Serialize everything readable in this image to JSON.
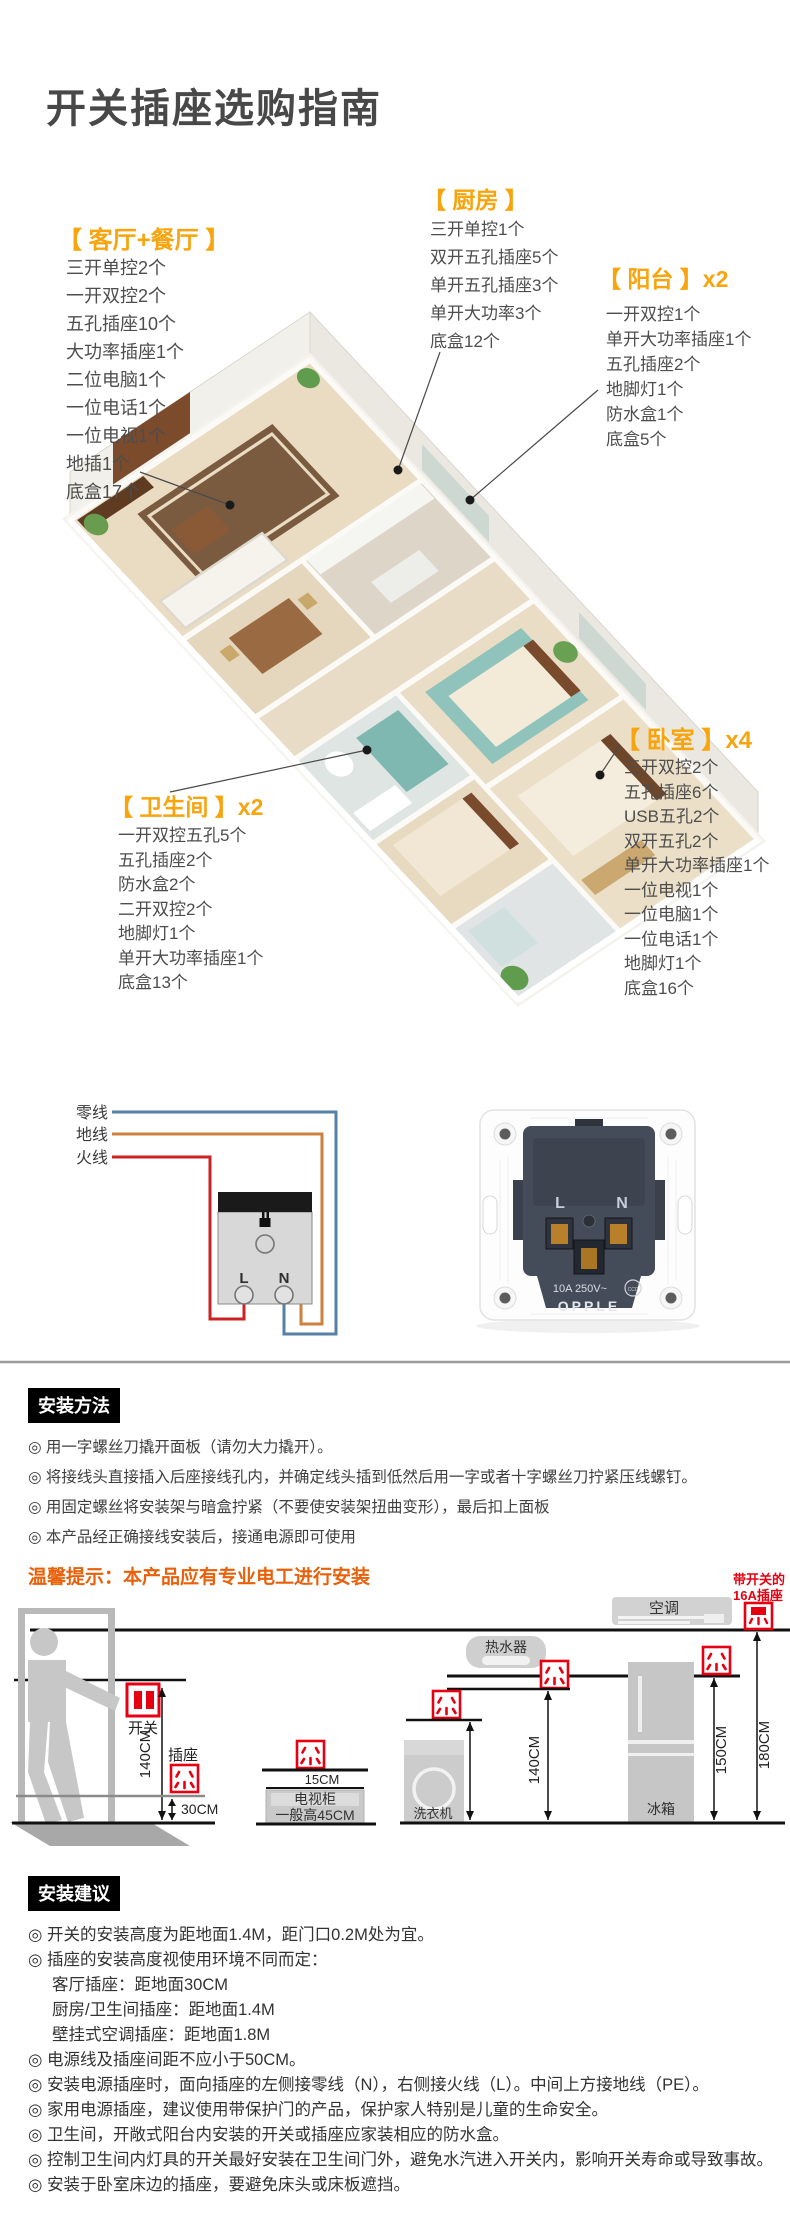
{
  "page": {
    "title": "开关插座选购指南"
  },
  "rooms": {
    "living": {
      "label": "【 客厅+餐厅 】",
      "items": [
        "三开单控2个",
        "一开双控2个",
        "五孔插座10个",
        "大功率插座1个",
        "二位电脑1个",
        "一位电话1个",
        "一位电视1个",
        "地插1个",
        "底盒17个"
      ]
    },
    "kitchen": {
      "label": "【 厨房 】",
      "items": [
        "三开单控1个",
        "双开五孔插座5个",
        "单开五孔插座3个",
        "单开大功率3个",
        "底盒12个"
      ]
    },
    "balcony": {
      "label": "【 阳台 】x2",
      "items": [
        "一开双控1个",
        "单开大功率插座1个",
        "五孔插座2个",
        "地脚灯1个",
        "防水盒1个",
        "底盒5个"
      ]
    },
    "bedroom": {
      "label": "【 卧室 】x4",
      "items": [
        "三开双控2个",
        "五孔插座6个",
        "USB五孔2个",
        "双开五孔2个",
        "单开大功率插座1个",
        "一位电视1个",
        "一位电脑1个",
        "一位电话1个",
        "地脚灯1个",
        "底盒16个"
      ]
    },
    "bathroom": {
      "label": "【 卫生间 】x2",
      "items": [
        "一开双控五孔5个",
        "五孔插座2个",
        "防水盒2个",
        "二开双控2个",
        "地脚灯1个",
        "单开大功率插座1个",
        "底盒13个"
      ]
    }
  },
  "wiring": {
    "neutral_label": "零线",
    "ground_label": "地线",
    "live_label": "火线",
    "terminal_l": "L",
    "terminal_n": "N"
  },
  "product": {
    "rating": "10A 250V~",
    "ccc": "CCC",
    "brand": "OPPLE"
  },
  "install_method": {
    "badge": "安装方法",
    "steps": [
      "◎ 用一字螺丝刀撬开面板（请勿大力撬开）。",
      "◎ 将接线头直接插入后座接线孔内，并确定线头插到低然后用一字或者十字螺丝刀拧紧压线螺钉。",
      "◎ 用固定螺丝将安装架与暗盒拧紧（不要使安装架扭曲变形），最后扣上面板",
      "◎ 本产品经正确接线安装后，接通电源即可使用"
    ],
    "warning": "温馨提示：本产品应有专业电工进行安装"
  },
  "height_diagram": {
    "switch": "开关",
    "socket": "插座",
    "h140_left": "140CM",
    "h30": "30CM",
    "tv_cm": "15CM",
    "tv_cabinet": "电视柜",
    "tv_height": "一般高45CM",
    "ac": "空调",
    "sw16_line1": "带开关的",
    "sw16_line2": "16A插座",
    "heater": "热水器",
    "washer": "洗衣机",
    "fridge": "冰箱",
    "h120": "120CM",
    "h140_mid": "140CM",
    "h150": "150CM",
    "h180": "180CM"
  },
  "install_advice": {
    "badge": "安装建议",
    "items": [
      "◎ 开关的安装高度为距地面1.4M，距门口0.2M处为宜。",
      "◎ 插座的安装高度视使用环境不同而定：",
      "客厅插座：距地面30CM",
      "厨房/卫生间插座：距地面1.4M",
      "壁挂式空调插座：距地面1.8M",
      "◎ 电源线及插座间距不应小于50CM。",
      "◎ 安装电源插座时，面向插座的左侧接零线（N），右侧接火线（L）。中间上方接地线（PE）。",
      "◎ 家用电源插座，建议使用带保护门的产品，保护家人特别是儿童的生命安全。",
      "◎ 卫生间，开敞式阳台内安装的开关或插座应家装相应的防水盒。",
      "◎ 控制卫生间内灯具的开关最好安装在卫生间门外，避免水汽进入开关内，影响开关寿命或导致事故。",
      "◎ 安装于卧室床边的插座，要避免床头或床板遮挡。"
    ]
  }
}
